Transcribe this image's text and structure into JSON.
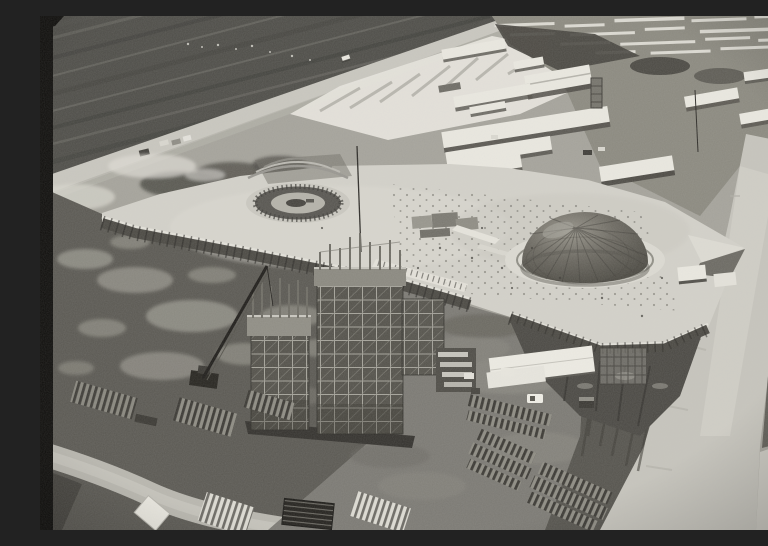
{
  "meta": {
    "medium": "black-and-white oblique aerial photograph, film negative with black left border",
    "subject": "Aerial view of a large modernist construction site: a vast flat concrete esplanade slab carrying a dark ribbed dome and a circular ring foundation, twin open-frame tower structures rising in front, a crawler crane, long white-roofed workers' barracks in the upper camp, lumber piles, sheds, trucks and wide earthen haul roads",
    "alt": "Black-and-white aerial photograph of a construction site with a wide concrete platform, a ribbed dome, a round ring foundation, twin skeletal tower frames, barracks rows, lumber stacks, sheds, trucks and dirt roads"
  },
  "palette": {
    "film_border": "#0e0d0b",
    "field_dark": "#4e4d48",
    "road_light": "#c9c7bf",
    "cut_white": "#e7e5dd",
    "camp_ground": "#8b897f",
    "vegetation": "#45433d",
    "roof_white": "#eae8e0",
    "slab": "#d3d1c9",
    "ring_dark": "#575550",
    "dome_dark": "#54524b",
    "dome_rim": "#dcdad2",
    "ground_dark": "#5a5852",
    "yard": "#7b7973",
    "haul_road": "#c6c4bc",
    "gully": "#55534d",
    "lattice_dark": "#54524b",
    "scrub": "#4a4843",
    "truck_white": "#f0eee6"
  },
  "scene": {
    "elements": [
      {
        "name": "film-border",
        "label": "black film edge, left side"
      },
      {
        "name": "scraped-field",
        "label": "dark scraped terrain, upper left"
      },
      {
        "name": "upland-road",
        "label": "diagonal access road with one car"
      },
      {
        "name": "cut-slope",
        "label": "white excavation cut slope"
      },
      {
        "name": "construction-camp",
        "label": "workers' camp with long white-roofed barracks"
      },
      {
        "name": "esplanade-slab",
        "label": "large light concrete platform slab"
      },
      {
        "name": "chamber-ring-foundation",
        "label": "circular ring foundation on slab, left"
      },
      {
        "name": "senate-dome",
        "label": "dark ribbed dome on slab, right"
      },
      {
        "name": "tower-scaffold",
        "label": "twin open-frame tower structures under construction"
      },
      {
        "name": "crawler-crane",
        "label": "crawler crane with lattice boom"
      },
      {
        "name": "storage-shed",
        "label": "white-roofed storage shed"
      },
      {
        "name": "trucks",
        "label": "pickup and dump trucks in the yard"
      },
      {
        "name": "lumber-piles",
        "label": "striped stacks of lumber and pallets"
      },
      {
        "name": "haul-road",
        "label": "wide light haul road, lower right"
      },
      {
        "name": "erosion-gully",
        "label": "dark eroded embankment streaks"
      }
    ]
  }
}
